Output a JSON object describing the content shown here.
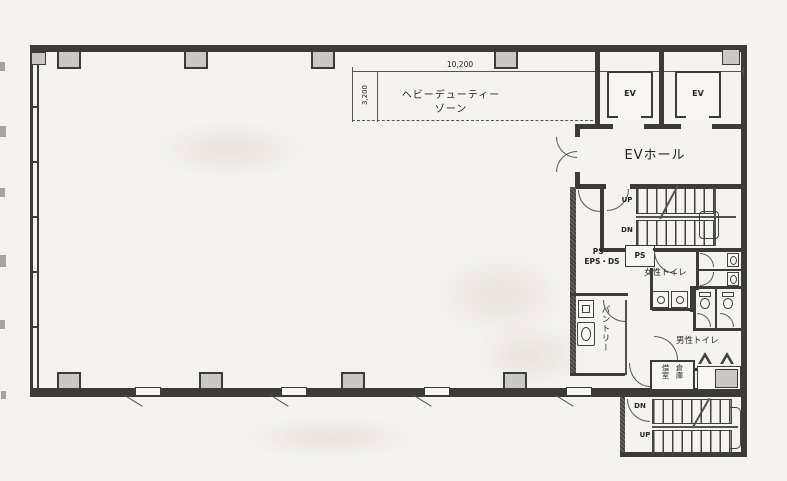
{
  "plan_title": "office-floor-plan",
  "zone": {
    "line1": "ヘビーデューティー",
    "line2": "ゾーン",
    "dim_w": "10,200",
    "dim_h": "3,200"
  },
  "elevators": {
    "ev1": "EV",
    "ev2": "EV",
    "hall": "EVホール"
  },
  "stairs_upper": {
    "up": "UP",
    "dn": "DN"
  },
  "stairs_lower": {
    "up": "UP",
    "dn": "DN"
  },
  "rooms": {
    "ps_eps_line1": "PS・",
    "ps_eps_line2": "EPS・DS",
    "ps": "PS",
    "womens": "女性トイレ",
    "mens": "男性トイレ",
    "pantry": "パントリー",
    "storage_col1": "借室",
    "storage_col2": "倉庫"
  },
  "colors": {
    "wall": "#3d3b38",
    "column_fill": "#c9c8c5",
    "paper": "#f4f3f0"
  }
}
